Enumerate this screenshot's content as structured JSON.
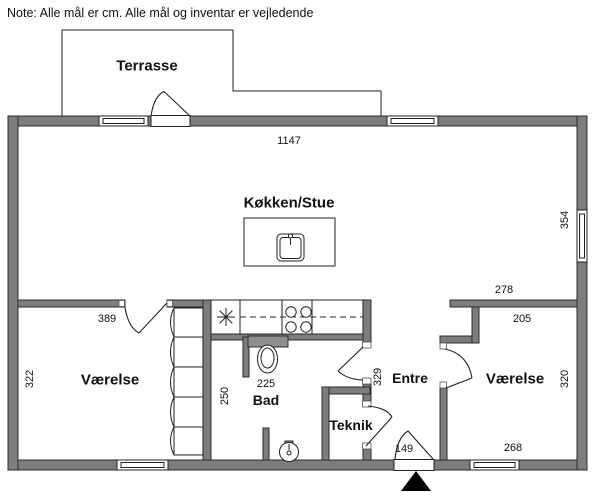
{
  "note": {
    "text": "Note: Alle mål er cm. Alle mål og inventar er vejledende"
  },
  "rooms": {
    "terrasse": "Terrasse",
    "kokken_stue": "Køkken/Stue",
    "vaerelse_left": "Værelse",
    "vaerelse_right": "Værelse",
    "bad": "Bad",
    "teknik": "Teknik",
    "entre": "Entre"
  },
  "dimensions": {
    "total_width": "1147",
    "living_height": "354",
    "vaerelse_left_width": "389",
    "vaerelse_left_height": "322",
    "bad_width": "225",
    "bad_height": "250",
    "entre_height": "329",
    "entre_top_width": "278",
    "vaerelse_right_width": "205",
    "vaerelse_right_height": "320",
    "vaerelse_right_bottom_width": "268",
    "entrance_width": "149"
  },
  "units": "cm",
  "colors": {
    "wall": "#7d7d7d",
    "fixture_gray": "#8f8f8f",
    "line": "#222222",
    "north_arrow": "#000000"
  },
  "icons": {
    "north_arrow": "north-arrow-triangle",
    "dishwasher": "asterisk-star",
    "stove": "four-burners",
    "sink_island": "kitchen-sink",
    "toilet": "toilet",
    "hand_sink": "round-basin"
  }
}
